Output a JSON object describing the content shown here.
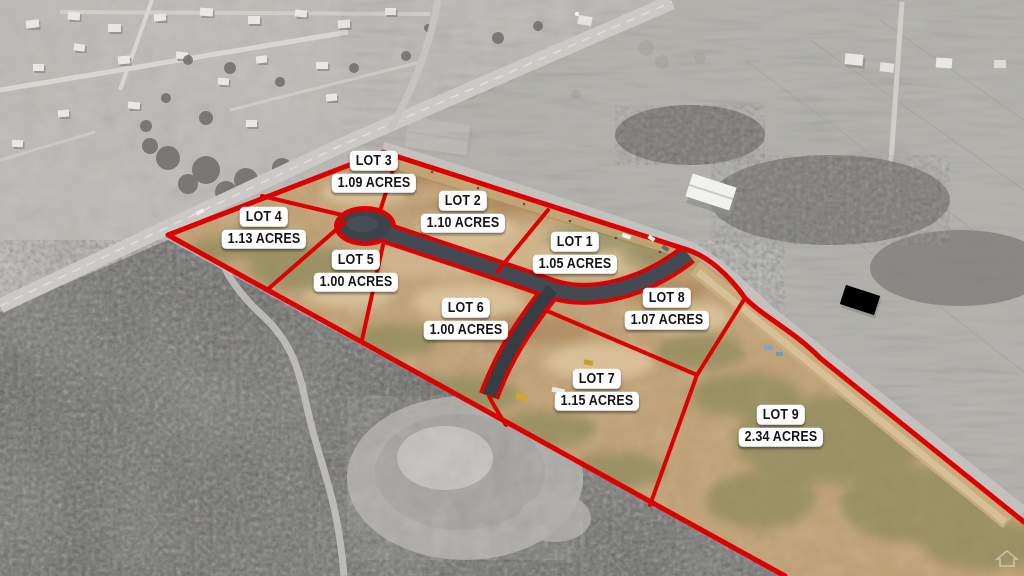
{
  "colors": {
    "boundary_red": "#dd0000",
    "label_background": "#ffffff",
    "label_text": "#151515",
    "dirt_tan": "#c2a173",
    "asphalt": "#454a52"
  },
  "lots": [
    {
      "name": "LOT 1",
      "acres": "1.05 ACRES"
    },
    {
      "name": "LOT 2",
      "acres": "1.10 ACRES"
    },
    {
      "name": "LOT 3",
      "acres": "1.09 ACRES"
    },
    {
      "name": "LOT 4",
      "acres": "1.13 ACRES"
    },
    {
      "name": "LOT 5",
      "acres": "1.00 ACRES"
    },
    {
      "name": "LOT 6",
      "acres": "1.00 ACRES"
    },
    {
      "name": "LOT 7",
      "acres": "1.15 ACRES"
    },
    {
      "name": "LOT 8",
      "acres": "1.07 ACRES"
    },
    {
      "name": "LOT 9",
      "acres": "2.34 ACRES"
    }
  ]
}
